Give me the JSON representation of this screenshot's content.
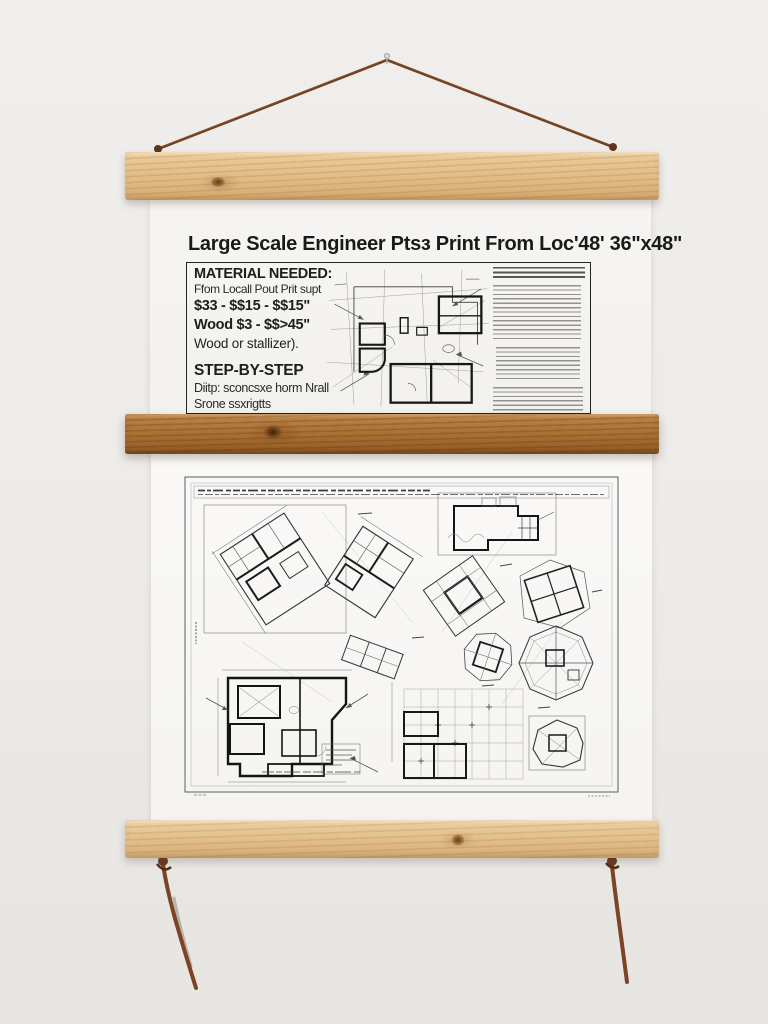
{
  "poster": {
    "title": "Large Scale Engineer Ptsɜ Print From Loc'48' 36\"x48\"",
    "materials": {
      "heading": "MATERIAL NEEDED:",
      "source_line": "Ffom Locall Pout Prit supt",
      "price_line_1": "$33 - $$15 - $$15\"",
      "price_line_2": "Wood $3 - $$>45\"",
      "wood_line": "Wood or stallizer)."
    },
    "steps": {
      "heading": "STEP-BY-STEP",
      "line_1": "Diitp: sconcsxe horm Nrall",
      "line_2": "Srone ssxrigtts"
    }
  },
  "hardware": {
    "top_bar": "natural-pine-hanger-bar",
    "middle_bar": "stained-oak-hanger-bar",
    "bottom_bar": "natural-pine-hanger-bar",
    "cord": "leather-hanging-cord"
  },
  "colors": {
    "wall": "#edebe8",
    "paper": "#f7f5f2",
    "pine_wood": "#e2bd8c",
    "stained_wood": "#a76d30",
    "leather_cord": "#6f4122",
    "ink": "#1b1b1b"
  }
}
